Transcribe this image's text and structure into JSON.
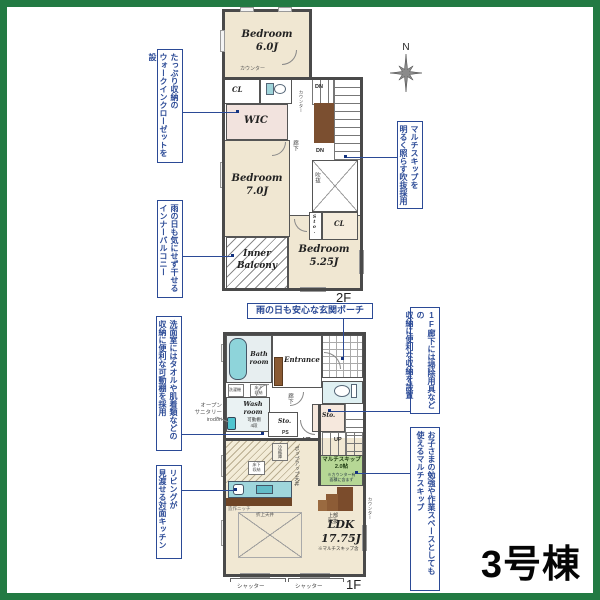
{
  "building": {
    "label": "3号棟"
  },
  "compass": {
    "n": "N"
  },
  "f2": {
    "floor_label": "2F",
    "bed6": "Bedroom\n6.0J",
    "bed7": "Bedroom\n7.0J",
    "bed525": "Bedroom\n5.25J",
    "wic": "WIC",
    "cl1": "CL",
    "cl2": "CL",
    "sto": "Sto.",
    "balcony": "Inner\nBalcony",
    "hall": "廊下",
    "void": "吹抜",
    "counter_top": "カウンター",
    "counter_stairs": "カウンター",
    "dn1": "DN",
    "dn2": "DN"
  },
  "f1": {
    "floor_label": "1F",
    "bath": "Bath\nroom",
    "entrance": "Entrance",
    "wash": "Wash\nroom",
    "washer": "洗濯機",
    "underfloor_a": "床下\n収納",
    "underfloor_b": "床下\n収納",
    "shelf": "可動棚\n4段",
    "hall": "廊下",
    "sto_a": "Sto.",
    "ps": "PS",
    "sto_b": "Sto.",
    "up1": "UP",
    "up2": "UP",
    "multiskip": "マルチスキップ\n2.0帖",
    "multiskip_note": "※カウンター有\n面積に含まず",
    "upper_void": "上部\n吹抜",
    "counter": "カウンター",
    "fridge": "冷蔵庫",
    "popup": "ポップアップ天井",
    "niche": "造作ニッチ",
    "coffered": "折上天井",
    "ldk": "LDK\n17.75J",
    "ldk_note": "※マルチスキップ含",
    "shutter1": "シャッター",
    "shutter2": "シャッター"
  },
  "annotations": {
    "wic_note": "たっぷり収納の\nウォークインクローゼットを設",
    "balcony_note": "雨の日も気にせず干せる\nインナーバルコニー",
    "void_note": "マルチスキップを\n明るく照らす吹抜採用",
    "porch_note": "雨の日も安心な玄関ポーチ",
    "storage_note": "1F廊下には掃除用具などの\n収納に便利な収納を設置",
    "multiskip_note": "お子さまの勉強や作業スペースとしても\n使えるマルチスキップ",
    "shelf_note": "洗面室にはタオルや肌着類などの\n収納に便利な可動棚を採用",
    "kitchen_note": "リビングが\n見渡せる対面キッチン",
    "open_sanitary": "オープン\nサニタリー\nirodori"
  },
  "colors": {
    "accent": "#2b4a96",
    "frame_green": "#227a43",
    "multiskip_green": "#b6d795"
  }
}
